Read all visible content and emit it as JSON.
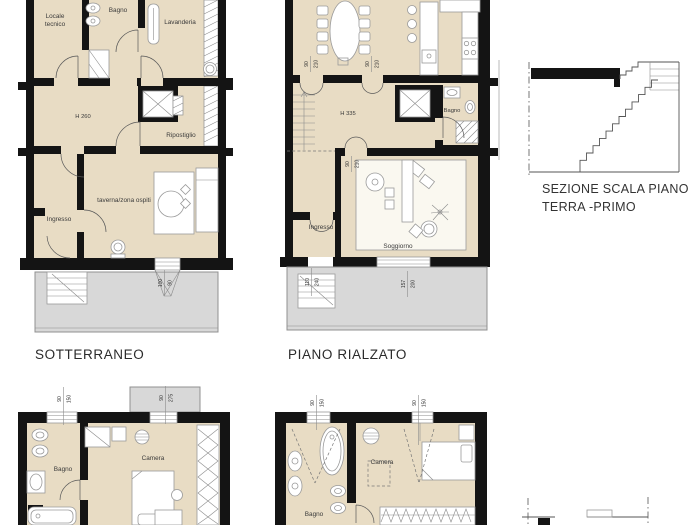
{
  "colors": {
    "wall": "#141414",
    "floor": "#e8dcc4",
    "terrace": "#d8d8d8",
    "paper": "#ffffff"
  },
  "sotterraneo": {
    "title": "SOTTERRANEO",
    "labels": {
      "locale_tecnico_1": "Locale",
      "locale_tecnico_2": "tecnico",
      "bagno": "Bagno",
      "lavanderia": "Lavanderia",
      "altezza": "H 260",
      "ripostiglio": "Ripostiglio",
      "taverna": "taverna/zona ospiti",
      "ingresso": "Ingresso"
    },
    "dims": {
      "finestra_terrazzo": {
        "w": "100",
        "h": "90"
      }
    }
  },
  "piano_rialzato": {
    "title": "PIANO RIALZATO",
    "labels": {
      "altezza": "H 335",
      "bagno": "Bagno",
      "ingresso": "Ingresso",
      "soggiorno": "Soggiorno"
    },
    "dims": {
      "porta_sx": {
        "w": "90",
        "h": "210"
      },
      "porta_dx": {
        "w": "90",
        "h": "210"
      },
      "porta_soggiorno": {
        "w": "90",
        "h": "210"
      },
      "porta_ingresso": {
        "w": "110",
        "h": "240"
      },
      "finestra_terrazzo": {
        "w": "157",
        "h": "200"
      }
    }
  },
  "sezione": {
    "caption_1": "SEZIONE SCALA PIANO",
    "caption_2": "TERRA -PRIMO"
  },
  "camere_sx": {
    "labels": {
      "bagno": "Bagno",
      "camera": "Camera"
    },
    "dims": {
      "finestra_sx": {
        "w": "90",
        "h": "150"
      },
      "finestra_dx": {
        "w": "90",
        "h": "275"
      }
    }
  },
  "camere_dx": {
    "labels": {
      "bagno": "Bagno",
      "camera": "Camera"
    },
    "dims": {
      "finestra_sx": {
        "w": "90",
        "h": "150"
      },
      "finestra_dx": {
        "w": "90",
        "h": "150"
      }
    }
  }
}
